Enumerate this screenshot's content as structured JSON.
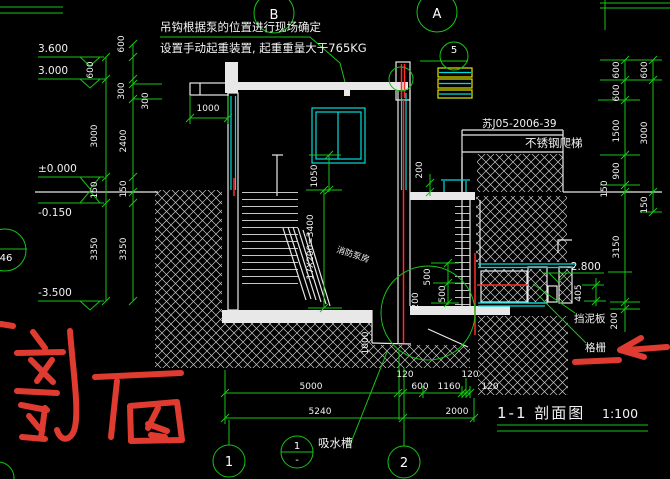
{
  "texts": {
    "note1": "吊钩根据泵的位置进行现场确定",
    "note2": "设置手动起重装置, 起重重量大于765KG",
    "ref": "苏J05-2006-39",
    "ladder": "不锈钢爬梯",
    "mudguard": "挡泥板",
    "grille": "格栅",
    "room": "消防泵房",
    "sump": "吸水槽",
    "handwritten": "剖面",
    "title": "1-1 剖面图",
    "scale": "1:100"
  },
  "bubbles": {
    "b": "B",
    "a": "A",
    "n1": "1",
    "n2": "2",
    "left": "46",
    "d5": "5",
    "sump_num": "1",
    "sump_sheet": "-"
  },
  "elevations": {
    "e3600": "3.600",
    "e3000": "3.000",
    "e0": "±0.000",
    "em150": "-0.150",
    "em3500": "-3.500",
    "em2800": "-2.800"
  },
  "dims_left": [
    "600",
    "600",
    "300",
    "300",
    "3000",
    "2400",
    "150",
    "150",
    "3350",
    "3350"
  ],
  "dims_right": [
    "600",
    "600",
    "600",
    "1500",
    "3000",
    "900",
    "150",
    "150",
    "3150",
    "200"
  ],
  "dims_inner": [
    "1000",
    "1050",
    "200",
    "17X200=3400",
    "500",
    "500",
    "200",
    "1000",
    "405"
  ],
  "dims_bottom": [
    "5000",
    "120",
    "600",
    "1160",
    "120",
    "120",
    "5240",
    "2000"
  ],
  "colors": {
    "background": "#000000",
    "cad_green": "#17c517",
    "cad_white": "#e8e8e8",
    "cad_cyan": "#00dcdc",
    "cad_red": "#ff2a2a",
    "cad_yellow": "#e6e600",
    "freehand_red": "#e03b30"
  }
}
